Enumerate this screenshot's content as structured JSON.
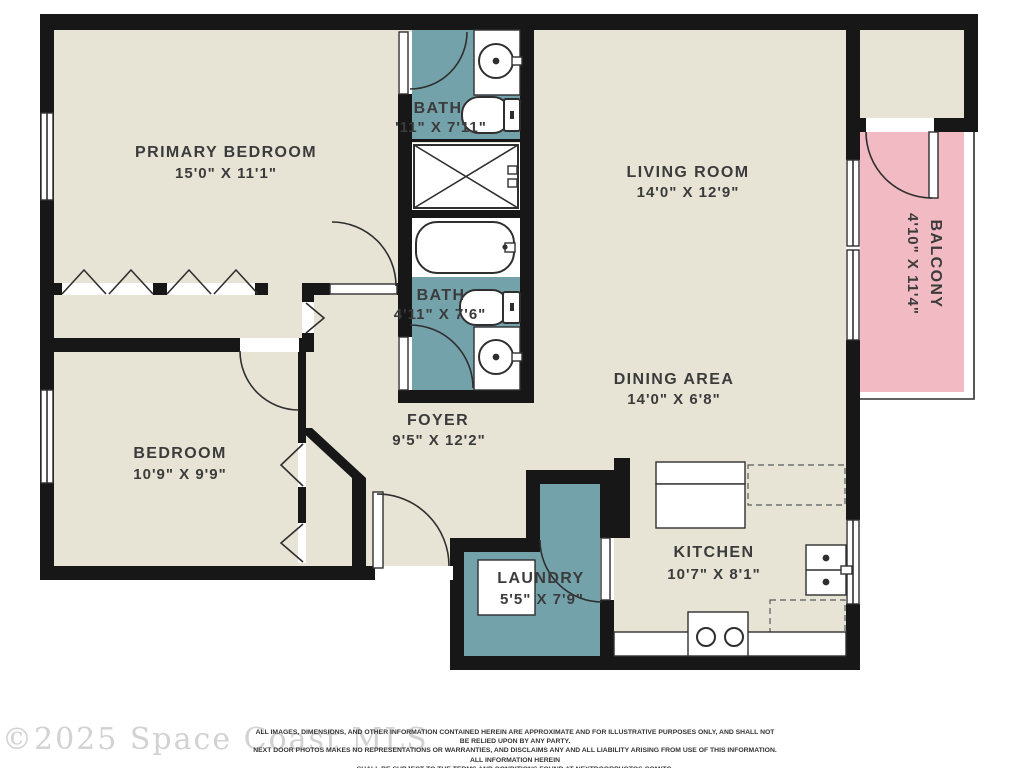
{
  "watermark": "©2025 Space Coast MLS",
  "disclaimer": {
    "line1": "ALL IMAGES, DIMENSIONS, AND OTHER INFORMATION CONTAINED HEREIN ARE APPROXIMATE AND FOR ILLUSTRATIVE PURPOSES ONLY, AND SHALL NOT BE RELIED UPON BY ANY PARTY.",
    "line2": "NEXT DOOR PHOTOS MAKES NO REPRESENTATIONS OR WARRANTIES, AND DISCLAIMS ANY AND ALL LIABILITY ARISING FROM USE OF THIS INFORMATION. ALL INFORMATION HEREIN",
    "line3": "SHALL BE SUBJECT TO THE TERMS AND CONDITIONS FOUND AT NEXTDOORPHOTOS.COM/TC."
  },
  "rooms": {
    "primary_bedroom": {
      "name": "PRIMARY BEDROOM",
      "dims": "15'0\" X 11'1\""
    },
    "bath_top": {
      "name": "BATH",
      "dims": "'11\" X 7'11\""
    },
    "living_room": {
      "name": "LIVING ROOM",
      "dims": "14'0\" X 12'9\""
    },
    "balcony": {
      "name": "BALCONY",
      "dims": "4'10\" X 11'4\""
    },
    "bath_middle": {
      "name": "BATH",
      "dims": "4'11\" X 7'6\""
    },
    "dining_area": {
      "name": "DINING AREA",
      "dims": "14'0\" X 6'8\""
    },
    "foyer": {
      "name": "FOYER",
      "dims": "9'5\" X 12'2\""
    },
    "bedroom": {
      "name": "BEDROOM",
      "dims": "10'9\" X 9'9\""
    },
    "kitchen": {
      "name": "KITCHEN",
      "dims": "10'7\" X 8'1\""
    },
    "laundry": {
      "name": "LAUNDRY",
      "dims": "5'5\" X 7'9\""
    }
  },
  "colors": {
    "floor": "#E7E4D6",
    "wet": "#74A2AB",
    "balcony": "#F2BBC3",
    "wall": "#171717",
    "label": "#3B3B3B",
    "line": "#2F2F2F",
    "watermark": "#D2D2D2"
  }
}
